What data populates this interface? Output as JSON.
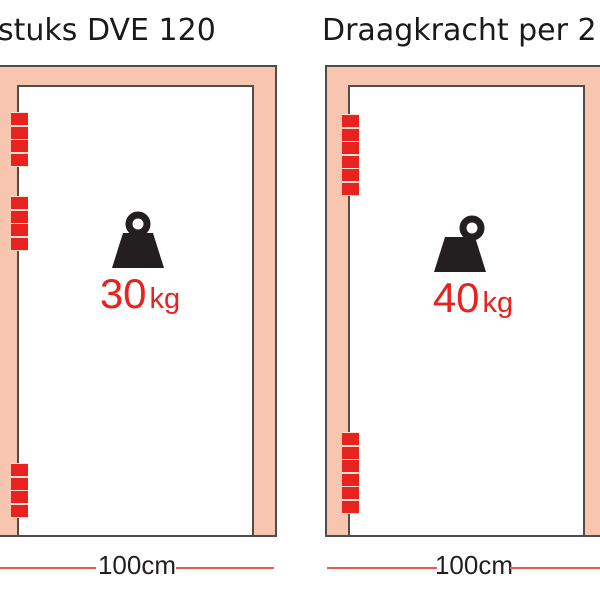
{
  "colors": {
    "frame_fill": "#F8C5AE",
    "hinge_red": "#E8221E",
    "hinge_gap": "#F8E2D6",
    "outline": "#4D4D4D",
    "dimension_line_red": "#EF5A50",
    "title_text": "#1A1A1A",
    "measure_text": "#231F20",
    "weight_icon_black": "#231F20"
  },
  "panels": [
    {
      "title": "stuks DVE 120",
      "weight": {
        "value": "30",
        "unit": "kg"
      },
      "width_label": "100cm",
      "hinges": [
        {
          "segments": 4
        },
        {
          "segments": 4
        },
        {
          "segments": 4
        }
      ]
    },
    {
      "title": "Draagkracht per 2",
      "weight": {
        "value": "40",
        "unit": "kg"
      },
      "width_label": "100cm",
      "hinges": [
        {
          "segments": 6
        },
        {
          "segments": 6
        }
      ]
    }
  ]
}
